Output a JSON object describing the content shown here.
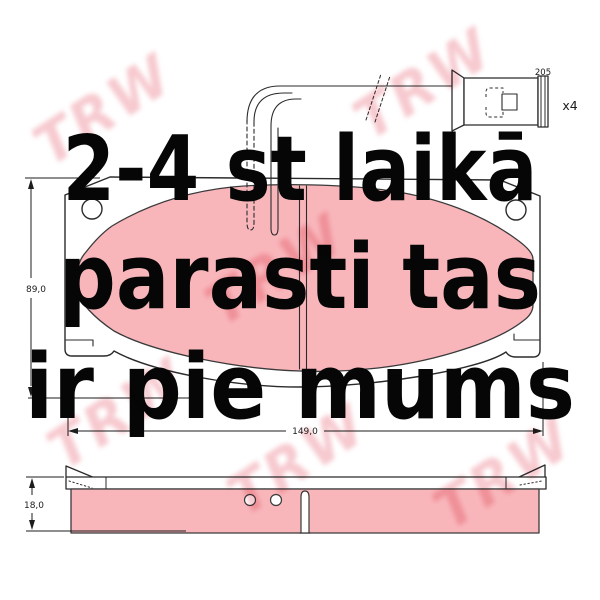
{
  "overlay": {
    "line1": "2-4 st laikā",
    "line2": "parasti tas",
    "line3": "ir pie mums"
  },
  "watermark": {
    "text": "TRW",
    "color": "#ee95a0"
  },
  "diagram": {
    "description": "brake pad set technical drawing, top view with wear sensor and side view",
    "dimensions": {
      "pad_height": "89,0",
      "pad_width": "149,0",
      "pad_thickness": "18,0",
      "sensor_wire_length": "205",
      "sensor_quantity": "x4"
    },
    "colors": {
      "friction_material": "#f8b6bb",
      "outline": "#2b2b2b",
      "overlay_text": "#060606"
    }
  }
}
